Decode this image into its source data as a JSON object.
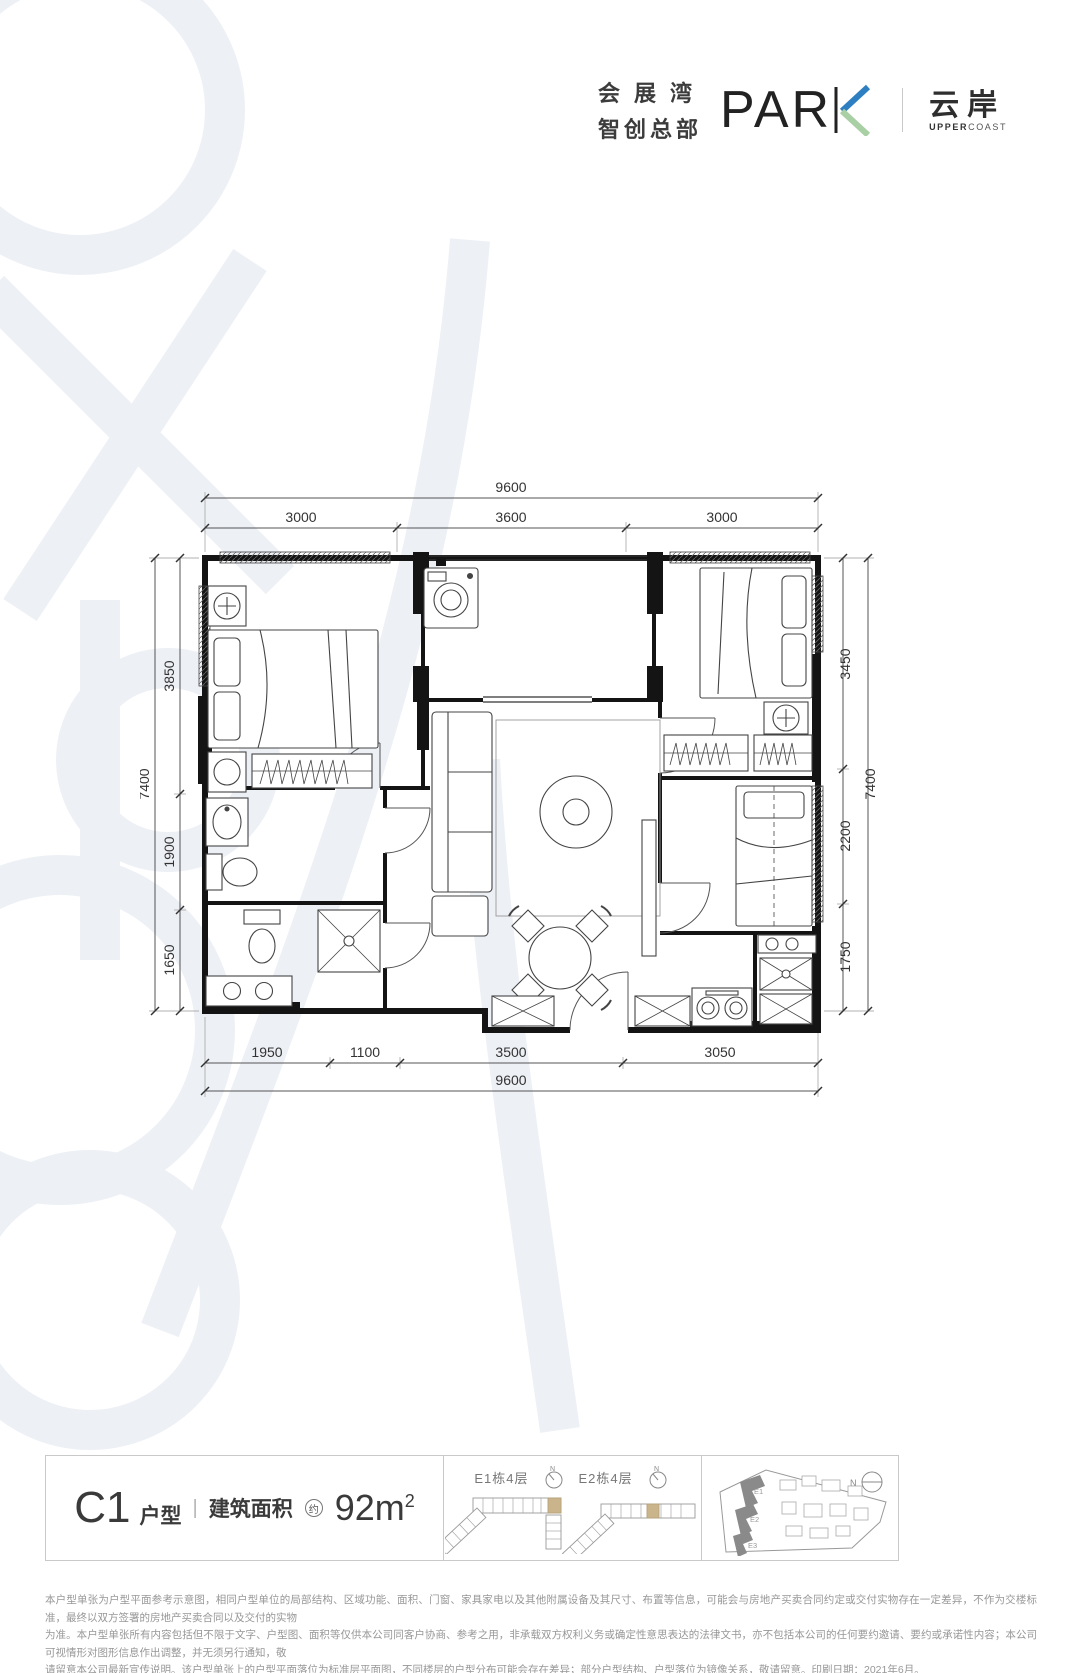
{
  "logo": {
    "cn_line1": "会展湾",
    "cn_line2": "智创总部",
    "wordmark_prefix": "PAR",
    "wordmark_k": "K",
    "brand_cn": "云岸",
    "brand_en_bold": "UPPER",
    "brand_en_light": "COAST"
  },
  "plan": {
    "dim_top_overall": "9600",
    "dim_top_segments": [
      "3000",
      "3600",
      "3000"
    ],
    "dim_bottom_segments": [
      "1950",
      "1100",
      "3500",
      "3050"
    ],
    "dim_bottom_overall": "9600",
    "dim_left_segments": [
      "3850",
      "1900",
      "1650"
    ],
    "dim_left_overall": "7400",
    "dim_right_segments": [
      "3450",
      "2200",
      "1750"
    ],
    "dim_right_overall": "7400"
  },
  "info": {
    "unit_code": "C1",
    "unit_suffix": "户型",
    "divider": "|",
    "area_label": "建筑面积",
    "area_circle": "约",
    "area_value": "92m",
    "area_sup": "2"
  },
  "floor_key": {
    "items": [
      {
        "label": "E1栋4层"
      },
      {
        "label": "E2栋4层"
      }
    ],
    "compass": "N"
  },
  "site_plan": {
    "buildings": [
      "E1",
      "E2",
      "E3"
    ],
    "compass": "N"
  },
  "disclaimer": {
    "lines": [
      "本户型单张为户型平面参考示意图，相同户型单位的局部结构、区域功能、面积、门窗、家具家电以及其他附属设备及其尺寸、布置等信息，可能会与房地产买卖合同约定或交付实物存在一定差异，不作为交楼标准，最终以双方签署的房地产买卖合同以及交付的实物",
      "为准。本户型单张所有内容包括但不限于文字、户型图、面积等仅供本公司同客户协商、参考之用，非承载双方权利义务或确定性意思表达的法律文书，亦不包括本公司的任何要约邀请、要约或承诺性内容；本公司可视情形对图形信息作出调整，并无须另行通知，敬",
      "请留意本公司最新宣传说明。该户型单张上的户型平面落位为标准层平面图，不同楼层的户型分布可能会存在差异；部分户型结构、户型落位为镜像关系，敬请留意。印刷日期：2021年6月。"
    ]
  },
  "colors": {
    "accent_blue": "#2e7fc1",
    "accent_green": "#a9cfa4",
    "highlight_tan": "#c9b48c"
  }
}
